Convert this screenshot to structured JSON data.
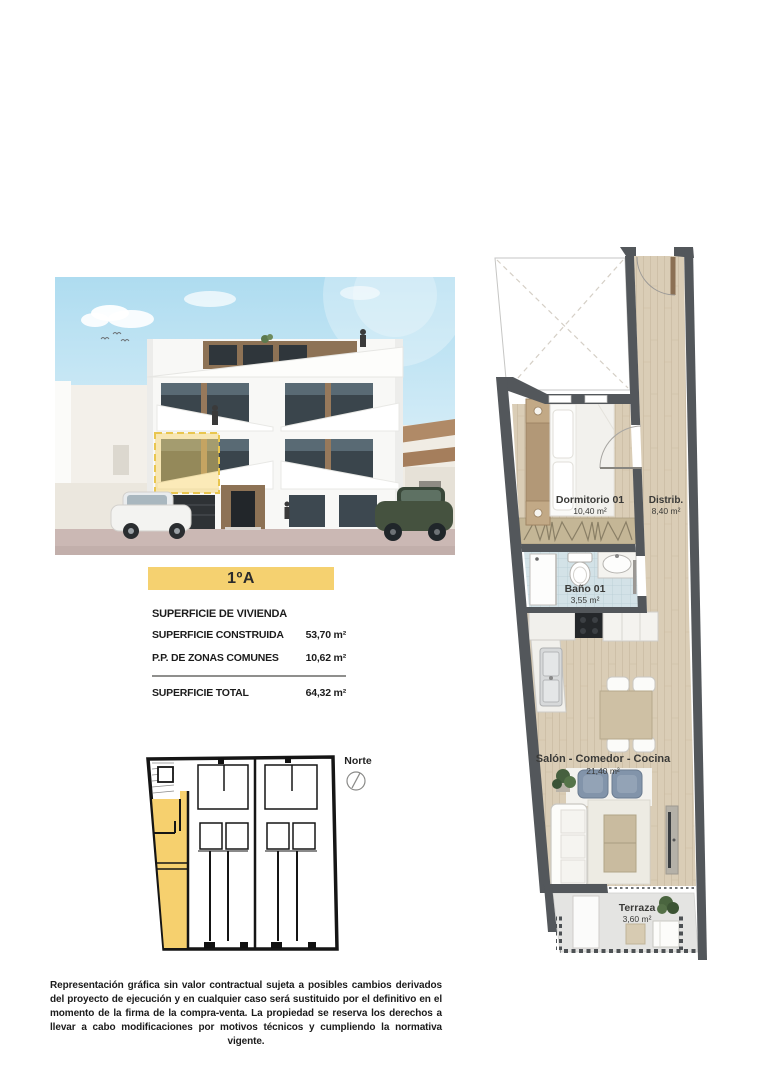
{
  "unit_label": "1ºA",
  "surface_table": {
    "header": "SUPERFICIE DE VIVIENDA",
    "rows": [
      {
        "label": "SUPERFICIE CONSTRUIDA",
        "value": "53,70 m²"
      },
      {
        "label": "P.P. DE ZONAS COMUNES",
        "value": "10,62 m²"
      }
    ],
    "total": {
      "label": "SUPERFICIE TOTAL",
      "value": "64,32 m²"
    }
  },
  "key_plan": {
    "north_label": "Norte"
  },
  "floor_plan": {
    "rooms": [
      {
        "name": "Dormitorio 01",
        "area": "10,40 m²"
      },
      {
        "name": "Distrib.",
        "area": "8,40 m²"
      },
      {
        "name": "Baño 01",
        "area": "3,55 m²"
      },
      {
        "name": "Salón - Comedor - Cocina",
        "area": "21,40 m²"
      },
      {
        "name": "Terraza",
        "area": "3,60 m²"
      }
    ]
  },
  "colors": {
    "highlight_yellow": "#f5d170",
    "wall_gray": "#53575b",
    "wood_floor": "#dacdb6",
    "bath_tile": "#d3e2e7",
    "terrace_floor": "#e4e4e2"
  },
  "disclaimer": "Representación gráfica sin valor contractual sujeta a posibles cambios derivados del proyecto de ejecución y en cualquier caso será sustituido por el definitivo en el momento de la firma de la compra-venta. La propiedad se reserva los derechos a llevar a cabo modificaciones por motivos técnicos y cumpliendo la normativa vigente."
}
